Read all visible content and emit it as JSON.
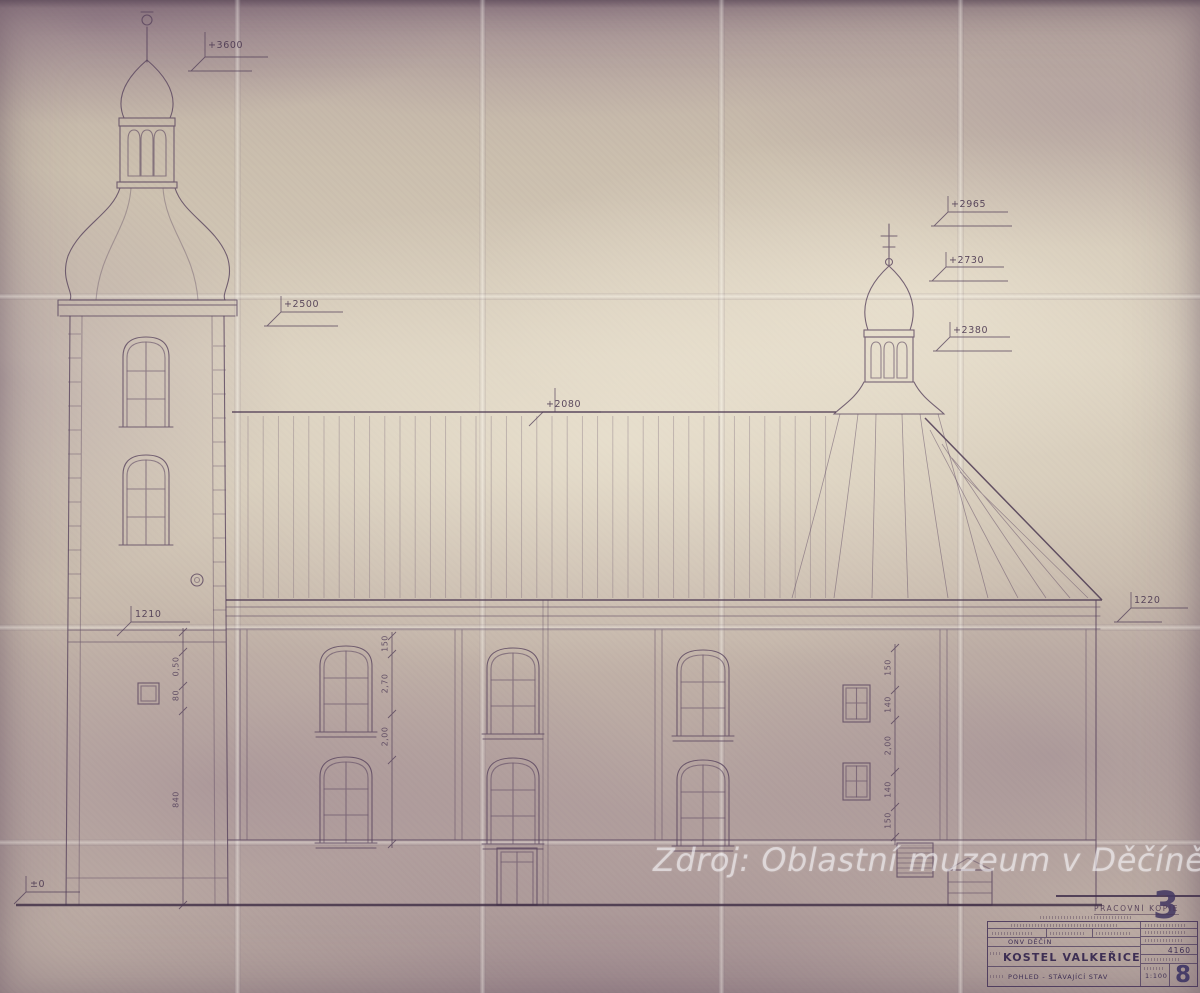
{
  "document": {
    "kind": "Scanned architectural elevation drawing of a church",
    "watermark": "Zdroj: Oblastní muzeum v Děčíně"
  },
  "markers": {
    "spire": "+3600",
    "tower_cornice": "+2500",
    "turret_top": "+2965",
    "turret_mid": "+2730",
    "turret_base": "+2380",
    "ridge": "+2080",
    "eaves_left": "1210",
    "eaves_right": "1220",
    "ground": "±0"
  },
  "dim_chains": {
    "tower": [
      "0,50",
      "80",
      "840"
    ],
    "nave_left": [
      "150",
      "2,70",
      "2,00"
    ],
    "nave_right": [
      "150",
      "140",
      "2,00",
      "140",
      "150"
    ]
  },
  "title_block": {
    "stamp": "PRACOVNÍ KOPIE",
    "corner_number": "3",
    "authority": "ONV DĚČÍN",
    "project_title": "KOSTEL VALKEŘICE",
    "drawing_title": "POHLED - STÁVAJÍCÍ STAV",
    "drawing_number": "4160",
    "scale": "1:100",
    "sheet_number": "8"
  },
  "colors": {
    "paper": "#cbbfae",
    "ink": "#57425c",
    "stamp_ink": "#453a63"
  }
}
